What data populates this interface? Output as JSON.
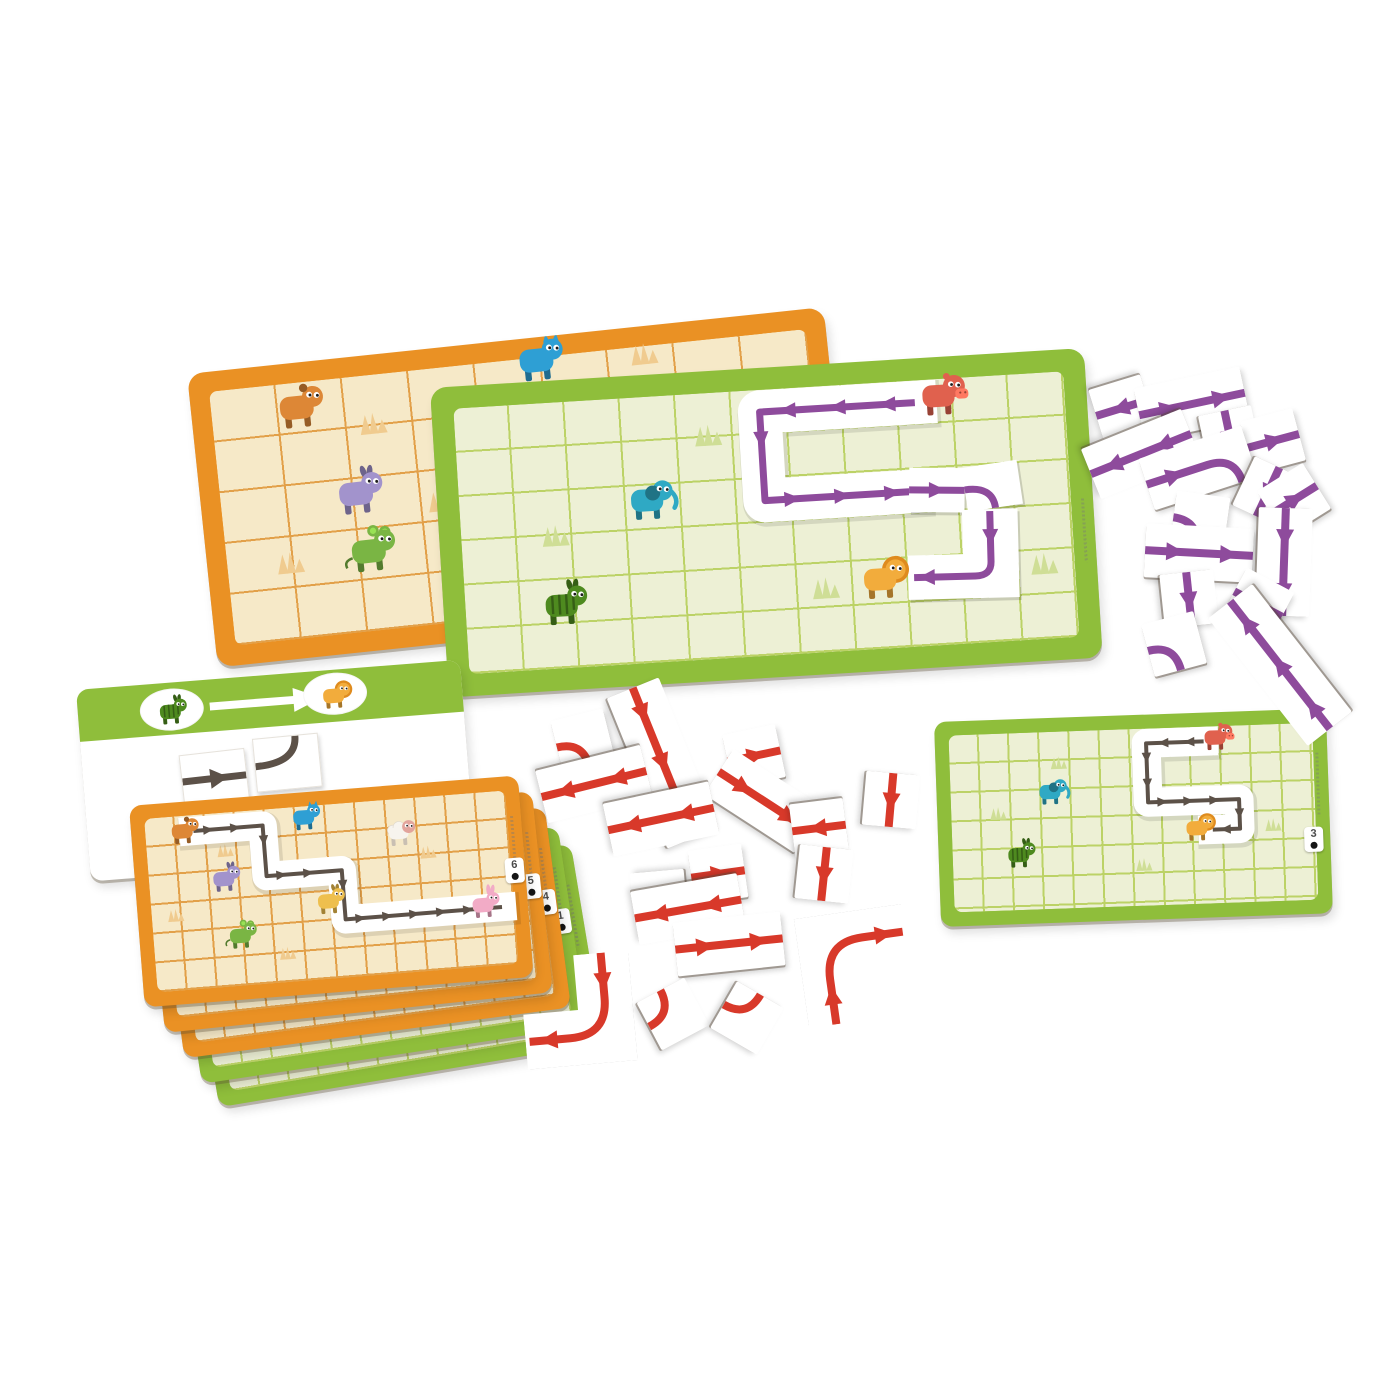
{
  "scene": {
    "background": "#ffffff"
  },
  "colors": {
    "orange_frame": "#EA9124",
    "orange_field": "#F6E9C8",
    "orange_grid": "#E2A049",
    "green_frame": "#8FBE3B",
    "green_field": "#EDF0D5",
    "green_grid": "#BCD266",
    "purple_arrow": "#8E4B9C",
    "red_arrow": "#D8392A",
    "dark_path": "#5C5148",
    "tile_white": "#FFFFFF",
    "grass_orange": "#F0CB8F",
    "grass_green": "#CFDE96"
  },
  "boards": {
    "orange": {
      "grass_color": "#F0CB8F",
      "grass": [
        [
          2.4,
          0.95
        ],
        [
          0.95,
          3.5
        ],
        [
          6.55,
          0.15
        ],
        [
          3.3,
          2.6
        ]
      ],
      "animals": [
        {
          "name": "dog",
          "color": "#DD8736",
          "at": [
            1.3,
            0.55
          ]
        },
        {
          "name": "cat",
          "color": "#2E9FD4",
          "at": [
            4.95,
            0.12
          ]
        },
        {
          "name": "donkey",
          "color": "#A293CC",
          "at": [
            2.05,
            2.35
          ]
        },
        {
          "name": "mouse",
          "color": "#7AB544",
          "at": [
            2.15,
            3.5
          ]
        }
      ]
    },
    "green": {
      "grass_color": "#CFDE96",
      "path_color": "#8E4B9C",
      "grass": [
        [
          4.55,
          0.95
        ],
        [
          1.7,
          3.0
        ],
        [
          6.5,
          4.55
        ],
        [
          10.45,
          4.3
        ]
      ],
      "animals": [
        {
          "name": "hippo",
          "color": "#E0614E",
          "at": [
            8.75,
            0.45
          ]
        },
        {
          "name": "elephant",
          "color": "#2FA9C4",
          "at": [
            3.4,
            2.4
          ]
        },
        {
          "name": "lion",
          "color": "#F2AC3C",
          "at": [
            7.5,
            4.5
          ]
        },
        {
          "name": "zebra",
          "color": "#4E8A1F",
          "at": [
            1.75,
            4.65
          ]
        }
      ],
      "corridor": [
        [
          8.3,
          0.5
        ],
        [
          5.5,
          0.5
        ],
        [
          5.5,
          2.5
        ],
        [
          8.1,
          2.5
        ]
      ],
      "loose_tiles": [
        {
          "kind": "straight",
          "at": [
            8.6,
            2.5
          ],
          "rot": 4
        },
        {
          "kind": "curve",
          "at": [
            9.6,
            2.48
          ],
          "rot": -5
        },
        {
          "kind": "corner_L",
          "at": [
            9.5,
            4.0
          ],
          "rot": 2
        }
      ]
    },
    "top_card": {
      "grass_color": "#F0CB8F",
      "path_color": "#5C5148",
      "grass": [
        [
          2.6,
          1.3
        ],
        [
          0.8,
          3.4
        ],
        [
          9.3,
          1.9
        ],
        [
          4.4,
          5.0
        ]
      ],
      "animals": [
        {
          "name": "dog",
          "color": "#DD8736",
          "at": [
            1.25,
            0.6
          ]
        },
        {
          "name": "cat",
          "color": "#2E9FD4",
          "at": [
            5.3,
            0.45
          ]
        },
        {
          "name": "sheep",
          "color": "#F7F4EE",
          "at": [
            8.4,
            1.25
          ]
        },
        {
          "name": "donkey",
          "color": "#A293CC",
          "at": [
            2.5,
            2.35
          ]
        },
        {
          "name": "horse",
          "color": "#EEBF4E",
          "at": [
            5.9,
            3.4
          ]
        },
        {
          "name": "mouse",
          "color": "#7AB544",
          "at": [
            2.9,
            4.35
          ]
        },
        {
          "name": "rabbit",
          "color": "#F2ABC6",
          "at": [
            11.0,
            3.95
          ]
        }
      ],
      "corridor": [
        [
          1.6,
          0.55
        ],
        [
          3.9,
          0.55
        ],
        [
          3.9,
          2.3
        ],
        [
          6.4,
          2.3
        ],
        [
          6.4,
          4.0
        ],
        [
          11.6,
          4.0
        ]
      ]
    },
    "mini_card": {
      "badge": "3",
      "grass_color": "#CFDE96",
      "path_color": "#5C5148",
      "grass": [
        [
          3.6,
          1.05
        ],
        [
          1.55,
          2.7
        ],
        [
          6.3,
          4.6
        ],
        [
          10.6,
          3.4
        ]
      ],
      "animals": [
        {
          "name": "hippo",
          "color": "#E0614E",
          "at": [
            8.8,
            0.45
          ]
        },
        {
          "name": "elephant",
          "color": "#2FA9C4",
          "at": [
            3.3,
            2.1
          ]
        },
        {
          "name": "lion",
          "color": "#F2AC3C",
          "at": [
            8.1,
            3.5
          ]
        },
        {
          "name": "zebra",
          "color": "#4E8A1F",
          "at": [
            2.2,
            4.2
          ]
        }
      ],
      "corridor": [
        [
          8.4,
          0.5
        ],
        [
          6.5,
          0.5
        ],
        [
          6.5,
          2.5
        ],
        [
          9.5,
          2.5
        ],
        [
          9.5,
          3.5
        ],
        [
          8.6,
          3.5
        ]
      ]
    }
  },
  "card_stack": {
    "cards": [
      {
        "badge": "6",
        "color": "orange"
      },
      {
        "badge": "5",
        "color": "orange"
      },
      {
        "badge": "4",
        "color": "orange"
      },
      {
        "badge": "1",
        "color": "green"
      },
      {
        "badge": "",
        "color": "green"
      }
    ]
  },
  "instruction_card": {
    "start_animal": "zebra",
    "start_color": "#4E8A1F",
    "goal_animal": "lion",
    "goal_color": "#F2AC3C",
    "tiles": [
      "straight-arrow",
      "curve"
    ]
  },
  "piles": {
    "purple": {
      "color": "#8E4B9C",
      "tiles": [
        [
          1122,
          408,
          163,
          "s1"
        ],
        [
          1192,
          404,
          -12,
          "d2"
        ],
        [
          1230,
          437,
          78,
          "s1"
        ],
        [
          1273,
          441,
          -15,
          "s1"
        ],
        [
          1141,
          454,
          158,
          "d2"
        ],
        [
          1198,
          468,
          -18,
          "dc"
        ],
        [
          1268,
          492,
          115,
          "s1"
        ],
        [
          1294,
          500,
          -32,
          "s1"
        ],
        [
          1200,
          521,
          8,
          "c"
        ],
        [
          1199,
          553,
          3,
          "d2"
        ],
        [
          1284,
          562,
          92,
          "d2"
        ],
        [
          1189,
          599,
          84,
          "s1"
        ],
        [
          1258,
          604,
          28,
          "s1"
        ],
        [
          1174,
          644,
          -15,
          "c"
        ],
        [
          1280,
          665,
          232,
          "t3"
        ]
      ]
    },
    "red": {
      "color": "#D8392A",
      "tiles": [
        [
          583,
          741,
          -14,
          "c"
        ],
        [
          663,
          763,
          68,
          "t3"
        ],
        [
          594,
          784,
          166,
          "d2"
        ],
        [
          754,
          756,
          -12,
          "s1"
        ],
        [
          764,
          801,
          33,
          "d2"
        ],
        [
          661,
          819,
          168,
          "d2"
        ],
        [
          819,
          828,
          173,
          "s1"
        ],
        [
          891,
          800,
          95,
          "s1"
        ],
        [
          824,
          874,
          96,
          "s1"
        ],
        [
          718,
          874,
          -8,
          "s1"
        ],
        [
          659,
          898,
          -95,
          "c"
        ],
        [
          688,
          909,
          170,
          "d2"
        ],
        [
          729,
          944,
          -6,
          "d2"
        ],
        [
          578,
          1010,
          -5,
          "L"
        ],
        [
          673,
          1014,
          62,
          "c"
        ],
        [
          747,
          1018,
          120,
          "c"
        ],
        [
          856,
          966,
          172,
          "L"
        ]
      ]
    }
  }
}
